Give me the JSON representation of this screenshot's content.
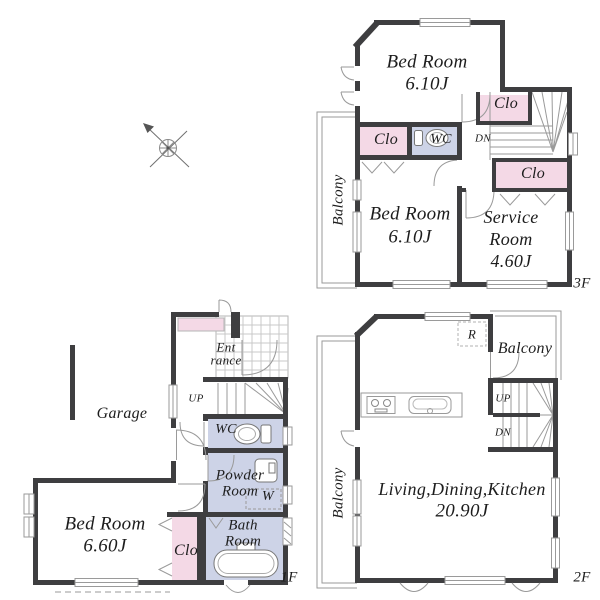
{
  "colors": {
    "wall": "#3e3e40",
    "closet_fill": "#f4d9e6",
    "wet_area_fill": "#cdd3e7",
    "thin_line": "#9a9a9a",
    "text": "#1d1d1d"
  },
  "floor3": {
    "floor_label": "3F",
    "balcony_label": "Balcony",
    "bedroom_top_name": "Bed Room",
    "bedroom_top_size": "6.10J",
    "closet_mid": "Clo",
    "wc": "WC",
    "closet_upper": "Clo",
    "down_label": "DN",
    "closet_lower": "Clo",
    "bedroom2_name": "Bed Room",
    "bedroom2_size": "6.10J",
    "service_line1": "Service",
    "service_line2": "Room",
    "service_size": "4.60J"
  },
  "floor2": {
    "floor_label": "2F",
    "balcony_left": "Balcony",
    "balcony_right": "Balcony",
    "fridge": "R",
    "up_label": "UP",
    "down_label": "DN",
    "ldk_name": "Living,Dining,Kitchen",
    "ldk_size": "20.90J"
  },
  "floor1": {
    "floor_label": "1F",
    "garage": "Garage",
    "entrance_line1": "Ent",
    "entrance_line2": "rance",
    "up_label": "UP",
    "wc": "WC",
    "powder_line1": "Powder",
    "powder_line2": "Room",
    "washer": "W",
    "bath_line1": "Bath",
    "bath_line2": "Room",
    "bedroom_name": "Bed Room",
    "bedroom_size": "6.60J",
    "closet": "Clo"
  }
}
